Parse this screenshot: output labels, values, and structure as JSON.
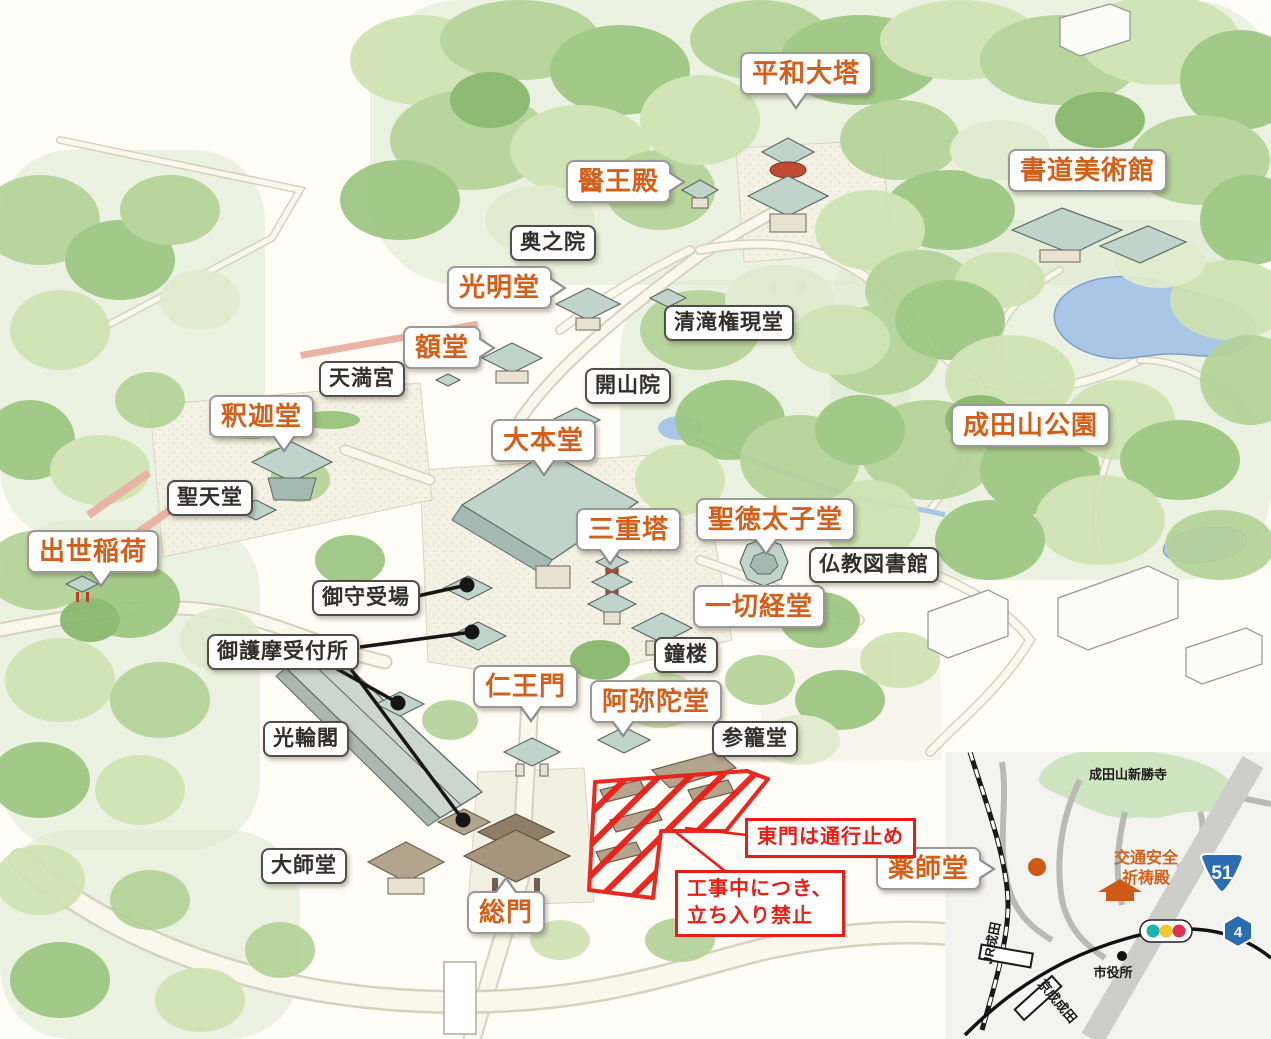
{
  "map": {
    "labels": [
      {
        "id": "heiwa-daito",
        "text": "平和大塔"
      },
      {
        "id": "io-den",
        "text": "醫王殿"
      },
      {
        "id": "shodo-museum",
        "text": "書道美術館"
      },
      {
        "id": "komyodo",
        "text": "光明堂"
      },
      {
        "id": "gakudo",
        "text": "額堂"
      },
      {
        "id": "shakado",
        "text": "釈迦堂"
      },
      {
        "id": "daihondo",
        "text": "大本堂"
      },
      {
        "id": "naritasan-park",
        "text": "成田山公園"
      },
      {
        "id": "sanjunoto",
        "text": "三重塔"
      },
      {
        "id": "shotoku-taishido",
        "text": "聖徳太子堂"
      },
      {
        "id": "shusse-inari",
        "text": "出世稲荷"
      },
      {
        "id": "issaikyodo",
        "text": "一切経堂"
      },
      {
        "id": "niomon",
        "text": "仁王門"
      },
      {
        "id": "amidado",
        "text": "阿弥陀堂"
      },
      {
        "id": "somon",
        "text": "総門"
      },
      {
        "id": "yakushido",
        "text": "薬師堂"
      },
      {
        "id": "okunoin",
        "text": "奥之院"
      },
      {
        "id": "seiryu-gongendo",
        "text": "清滝権現堂"
      },
      {
        "id": "tenmangu",
        "text": "天満宮"
      },
      {
        "id": "kaisanin",
        "text": "開山院"
      },
      {
        "id": "shotendo",
        "text": "聖天堂"
      },
      {
        "id": "bukkyo-library",
        "text": "仏教図書館"
      },
      {
        "id": "omamori-ukeba",
        "text": "御守受場"
      },
      {
        "id": "ogoma-uketsukesho",
        "text": "御護摩受付所"
      },
      {
        "id": "shoro",
        "text": "鐘楼"
      },
      {
        "id": "korinkaku",
        "text": "光輪閣"
      },
      {
        "id": "sanrodo",
        "text": "参籠堂"
      },
      {
        "id": "daishido",
        "text": "大師堂"
      }
    ]
  },
  "notices": {
    "east_gate_closed": "東門は通行止め",
    "construction_line1": "工事中につき、",
    "construction_line2": "立ち入り禁止"
  },
  "inset": {
    "temple_label": "成田山新勝寺",
    "kitoden_line1": "交通安全",
    "kitoden_line2": "祈祷殿",
    "route_51": "51",
    "route_4": "4",
    "jr_station": "JR成田",
    "keisei_station": "京成成田",
    "city_hall": "市役所"
  },
  "icons": {
    "yakushido_marker": "orange-dot-icon",
    "kitoden_building": "shrine-icon",
    "traffic_signal": "traffic-light-icon",
    "route_51_sign": "national-route-shield-icon",
    "route_4_sign": "prefectural-route-hexagon-icon"
  },
  "colors": {
    "label_orange": "#d2601a",
    "label_black": "#332f2c",
    "notice_red": "#ea1d15",
    "route_sign_blue": "#2a6db5",
    "pond_blue": "#a9c6e6",
    "signal_green": "#1cb5ab",
    "signal_yellow": "#f6c62e",
    "signal_red": "#e0344e"
  }
}
